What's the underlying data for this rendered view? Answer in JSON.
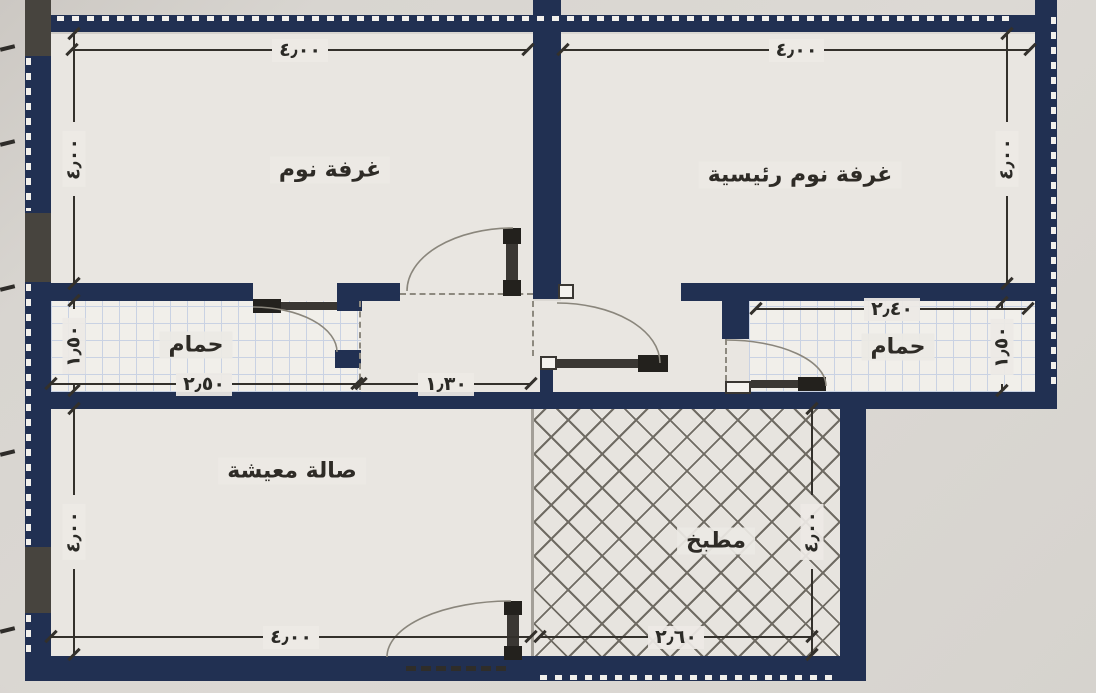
{
  "plan_type": "apartment-floor-plan",
  "rooms": {
    "bedroom": {
      "label": "غرفة نوم"
    },
    "master_bedroom": {
      "label": "غرفة نوم رئيسية"
    },
    "bathroom_left": {
      "label": "حمام"
    },
    "bathroom_right": {
      "label": "حمام"
    },
    "living_room": {
      "label": "صالة معيشة"
    },
    "kitchen": {
      "label": "مطبخ"
    }
  },
  "dimensions": {
    "bedroom_width": "٤٫٠٠",
    "master_bedroom_width": "٤٫٠٠",
    "bedroom_depth": "٤٫٠٠",
    "master_bedroom_depth": "٤٫٠٠",
    "bathroom_left_width": "٢٫٥٠",
    "bathroom_left_depth": "١٫٥٠",
    "hall_width": "١٫٣٠",
    "bathroom_right_width": "٢٫٤٠",
    "bathroom_right_depth": "١٫٥٠",
    "living_room_width": "٤٫٠٠",
    "living_room_depth": "٤٫٠٠",
    "kitchen_width": "٢٫٦٠",
    "kitchen_depth": "٤٫٠٠"
  },
  "colors": {
    "wall": "#213052",
    "floor": "#e9e6e1",
    "exterior": "#d8d5d0",
    "tile_line": "#c9d2e3",
    "hatch_line": "#6f6b63",
    "lintel": "#47443e",
    "dim_text": "#2b2a26",
    "door": "#3a3733",
    "arc": "#8a867c"
  }
}
